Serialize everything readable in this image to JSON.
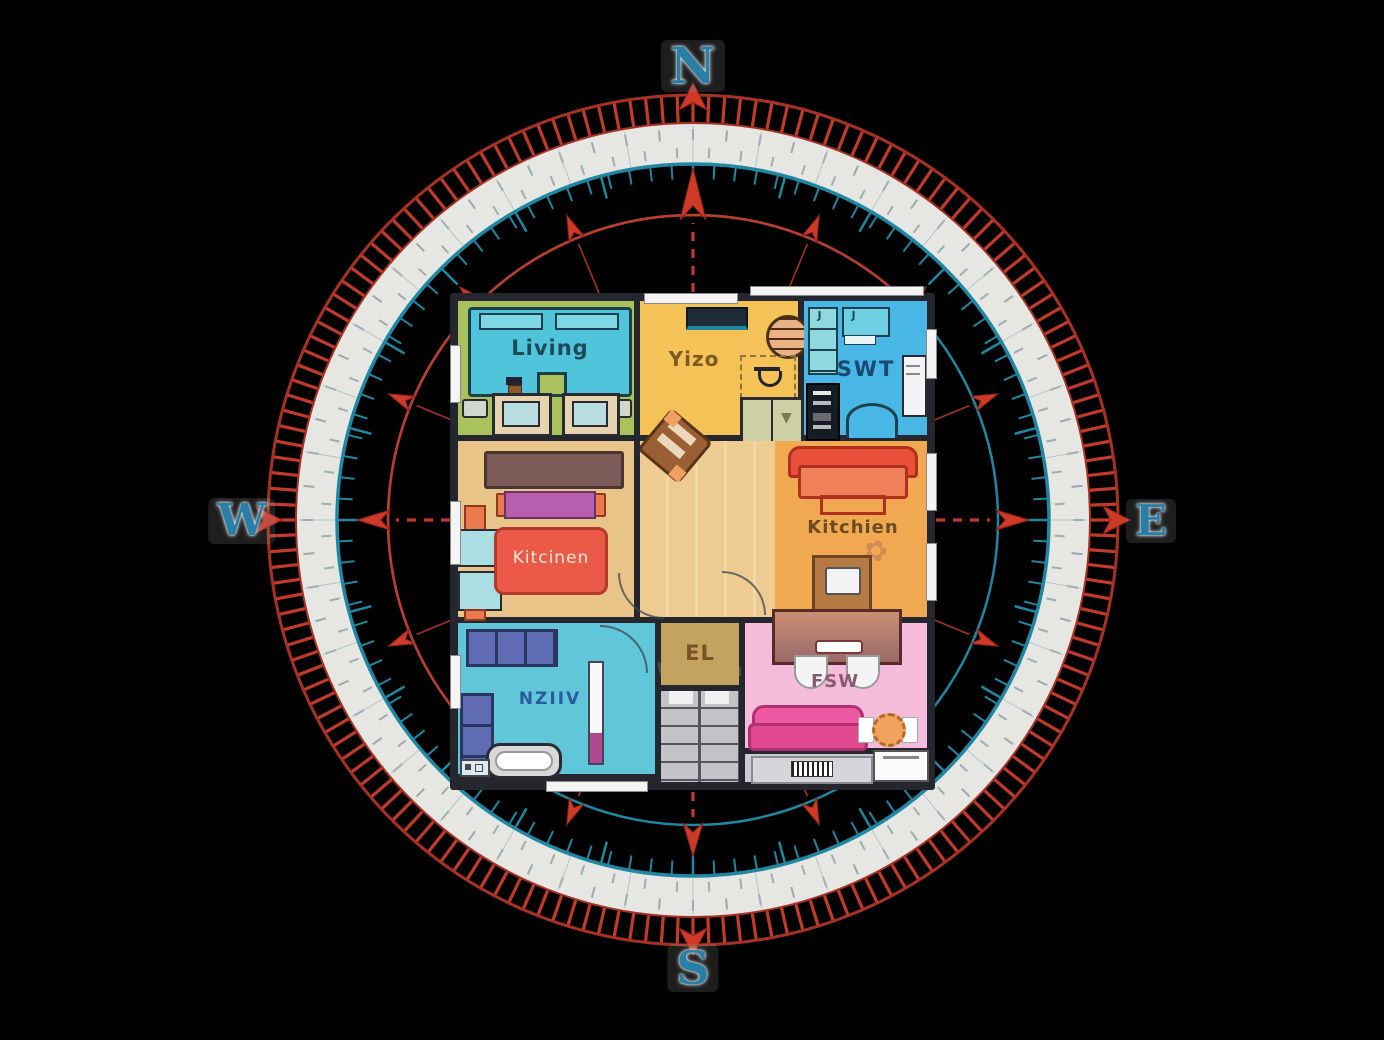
{
  "compass": {
    "north": "N",
    "east": "E",
    "south": "S",
    "west": "W",
    "colors": {
      "red": "#c13a2a",
      "dark_red": "#8e2417",
      "teal": "#1f87a2",
      "band_white": "#f2f2ee",
      "letter_blue": "#2a7fa8"
    }
  },
  "rooms": {
    "living": {
      "label": "Living"
    },
    "yizo": {
      "label": "Yizo"
    },
    "swt": {
      "label": "SWT"
    },
    "widhen": {
      "label": "Widhen"
    },
    "kitchien": {
      "label": "Kitchien"
    },
    "kitcinen_sofa": {
      "label": "Kitcinen"
    },
    "nziv": {
      "label": "NZIIV"
    },
    "el": {
      "label": "EL"
    },
    "fsw": {
      "label": "FSW"
    },
    "closet_tag": {
      "label": "J"
    }
  }
}
